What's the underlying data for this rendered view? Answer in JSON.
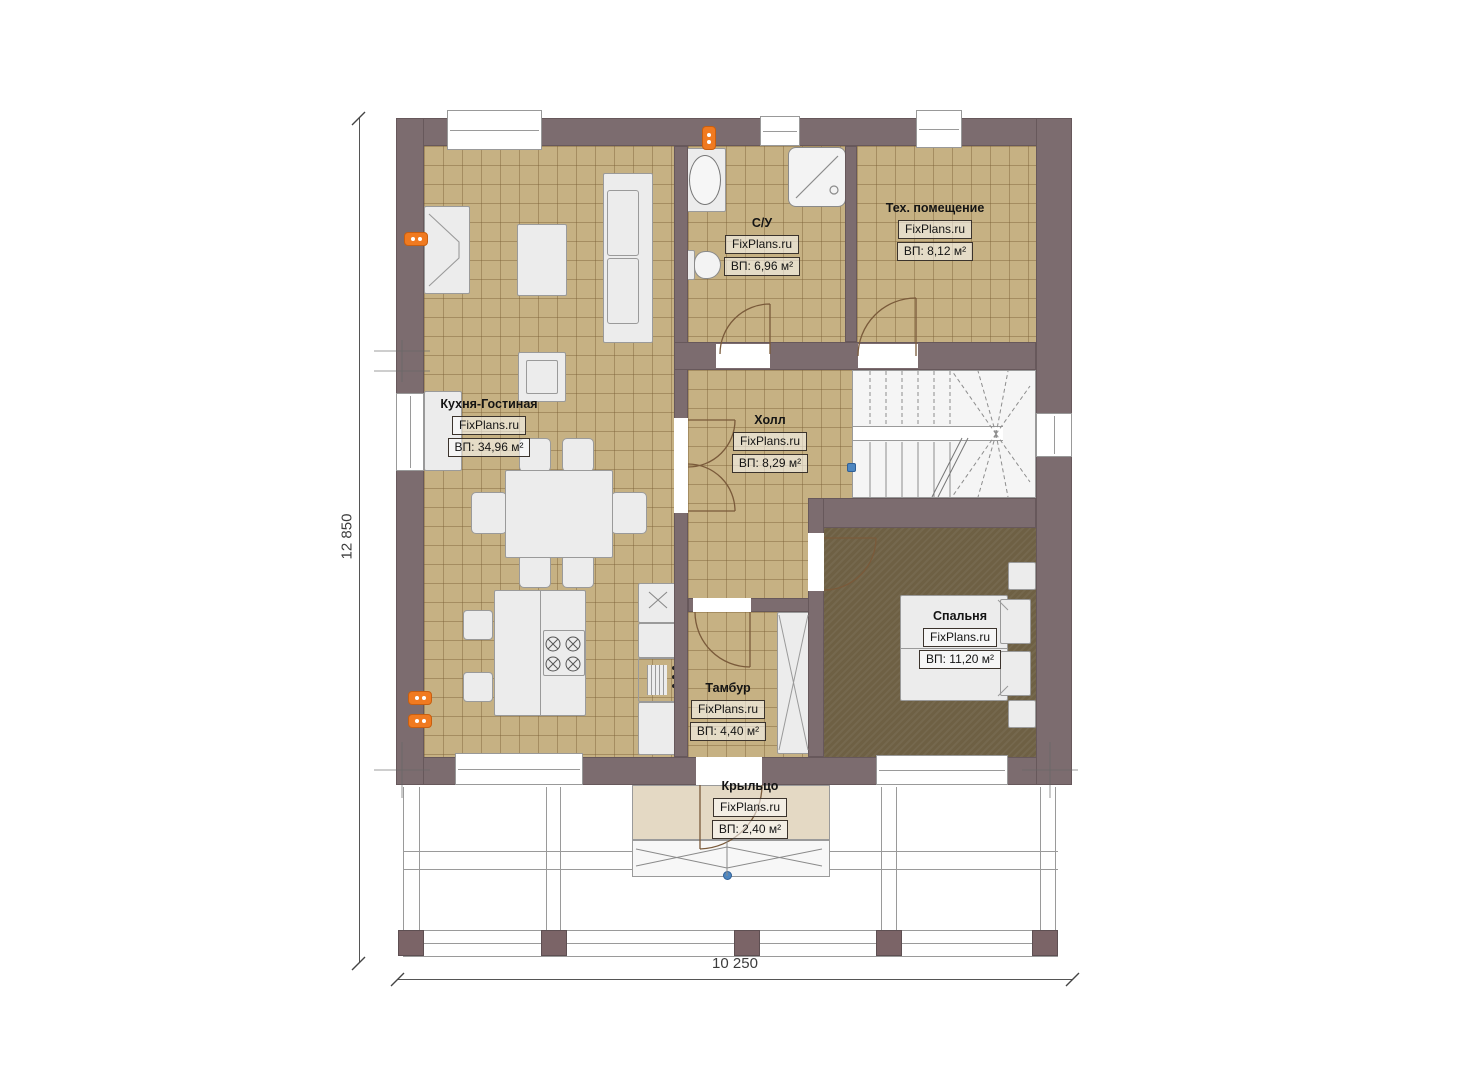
{
  "plan": {
    "rooms": {
      "kitchen_living": {
        "name": "Кухня-Гостиная",
        "brand": "FixPlans.ru",
        "area": "ВП: 34,96 м²"
      },
      "bathroom": {
        "name": "С/У",
        "brand": "FixPlans.ru",
        "area": "ВП: 6,96 м²"
      },
      "tech_room": {
        "name": "Тех. помещение",
        "brand": "FixPlans.ru",
        "area": "ВП: 8,12 м²"
      },
      "hall": {
        "name": "Холл",
        "brand": "FixPlans.ru",
        "area": "ВП: 8,29 м²"
      },
      "bedroom": {
        "name": "Спальня",
        "brand": "FixPlans.ru",
        "area": "ВП: 11,20 м²"
      },
      "vestibule": {
        "name": "Тамбур",
        "brand": "FixPlans.ru",
        "area": "ВП: 4,40 м²"
      },
      "porch": {
        "name": "Крыльцо",
        "brand": "FixPlans.ru",
        "area": "ВП: 2,40 м²"
      }
    },
    "dimensions": {
      "total_width": "10 250",
      "total_height": "12 850"
    },
    "colors": {
      "wall": "#7c6c6f",
      "tile_floor": "#c6b183",
      "bedroom_floor": "#6e6044",
      "porch_floor": "#e4d9c4",
      "outlet": "#f07a20",
      "marker": "#4d86c0"
    }
  }
}
